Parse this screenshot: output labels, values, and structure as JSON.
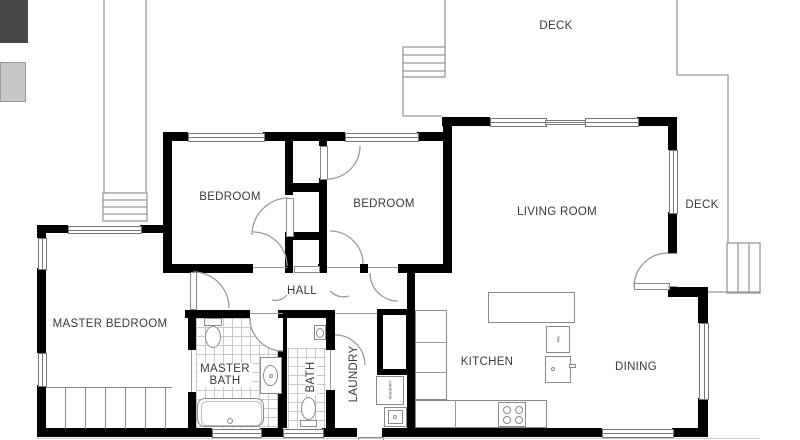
{
  "title": "House floor plan",
  "colors": {
    "wall": "#000000",
    "thin_line": "#9a9a9a",
    "text": "#3a3a3a",
    "tile_line": "#c8c8c8"
  },
  "rooms": {
    "deck_top": "DECK",
    "deck_right": "DECK",
    "bedroom1": "BEDROOM",
    "bedroom2": "BEDROOM",
    "living_room": "LIVING ROOM",
    "master_bedroom": "MASTER BEDROOM",
    "hall": "HALL",
    "master_bath_line1": "MASTER",
    "master_bath_line2": "BATH",
    "bath": "BATH",
    "laundry": "LAUNDRY",
    "kitchen": "KITCHEN",
    "dining": "DINING"
  },
  "fixtures": {
    "washer_dryer": "WSH/DRY",
    "range": "RG"
  }
}
